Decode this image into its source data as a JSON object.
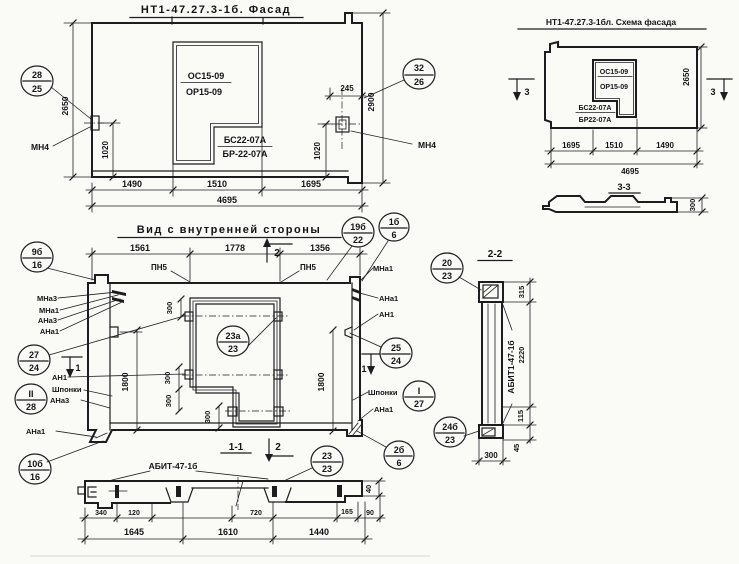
{
  "facade": {
    "title": "НТ1-47.27.3-1б. Фасад",
    "win1": "ОС15-09",
    "win2": "ОР15-09",
    "win3": "БС22-07А",
    "win4": "БР-22-07А",
    "callout_left_top": "28",
    "callout_left_bot": "25",
    "callout_right_top": "32",
    "callout_right_bot": "26",
    "anchor_left": "МН4",
    "anchor_right": "МН4",
    "dim_height": "2650",
    "dim_1020_left": "1020",
    "dim_245": "245",
    "dim_height_right": "2900",
    "dim_1020_right": "1020",
    "dim_b1": "1490",
    "dim_b2": "1510",
    "dim_b3": "1695",
    "dim_total": "4695"
  },
  "scheme": {
    "title": "НТ1-47.27.3-1бл. Схема фасада",
    "win1": "ОС15-09",
    "win2": "ОР15-09",
    "win3": "БС22-07А",
    "win4": "БР22-07А",
    "dim_height": "2650",
    "sec_left": "3",
    "sec_right": "3",
    "dim_b1": "1695",
    "dim_b2": "1510",
    "dim_b3": "1490",
    "dim_total": "4695",
    "section_title": "3-3",
    "section_dim": "300"
  },
  "inner": {
    "title": "Вид с внутренней стороны",
    "dim_t1": "1561",
    "dim_t2": "1778",
    "dim_t3": "1356",
    "pn5_left": "ПН5",
    "pn5_right": "ПН5",
    "callout_19b_top": "19б",
    "callout_19b_bot": "22",
    "callout_1b_top": "1б",
    "callout_1b_bot": "6",
    "sec2_top": "2",
    "sec2_bot": "2",
    "sec1_left": "1",
    "sec1_right": "1",
    "callout_9b_top": "9б",
    "callout_9b_bot": "16",
    "lbl_mna3": "МНа3",
    "lbl_mna1": "МНа1",
    "lbl_ana3": "АНа3",
    "lbl_ana1": "АНа1",
    "callout_27_top": "27",
    "callout_27_bot": "24",
    "lbl_an1": "АН1",
    "callout_28_top": "II",
    "callout_28_bot": "28",
    "lbl_shponki_left": "Шпонки",
    "lbl_ana3_b": "АНа3",
    "lbl_ana1_b": "АНа1",
    "callout_10b_top": "10б",
    "callout_10b_bot": "16",
    "r_mna1": "МНа1",
    "r_ana1": "АНа1",
    "r_an1": "АН1",
    "callout_25_top": "25",
    "callout_25_bot": "24",
    "lbl_shponki_right": "Шпонки",
    "callout_i27_top": "I",
    "callout_i27_bot": "27",
    "r_ana1_b": "АНа1",
    "callout_2b_top": "2б",
    "callout_2b_bot": "6",
    "win_callout_top": "23а",
    "win_callout_bot": "23",
    "dim_300_1": "300",
    "dim_300_2": "300",
    "dim_300_3": "300",
    "dim_300_4": "300",
    "dim_1800_l": "1800",
    "dim_1800_r": "1800"
  },
  "sec11": {
    "title": "1-1",
    "label": "АБИТ-47-1б",
    "callout_top": "23",
    "callout_bot": "23",
    "d340": "340",
    "d120": "120",
    "d720": "720",
    "d165": "165",
    "d90": "90",
    "d40": "40",
    "d1645": "1645",
    "d1610": "1610",
    "d1440": "1440"
  },
  "sec22": {
    "title": "2-2",
    "label": "АБИТ1-47-1б",
    "callout_20_top": "20",
    "callout_20_bot": "23",
    "callout_24b_top": "24б",
    "callout_24b_bot": "23",
    "d315": "315",
    "d2220": "2220",
    "d115": "115",
    "d45": "45",
    "d300": "300"
  }
}
